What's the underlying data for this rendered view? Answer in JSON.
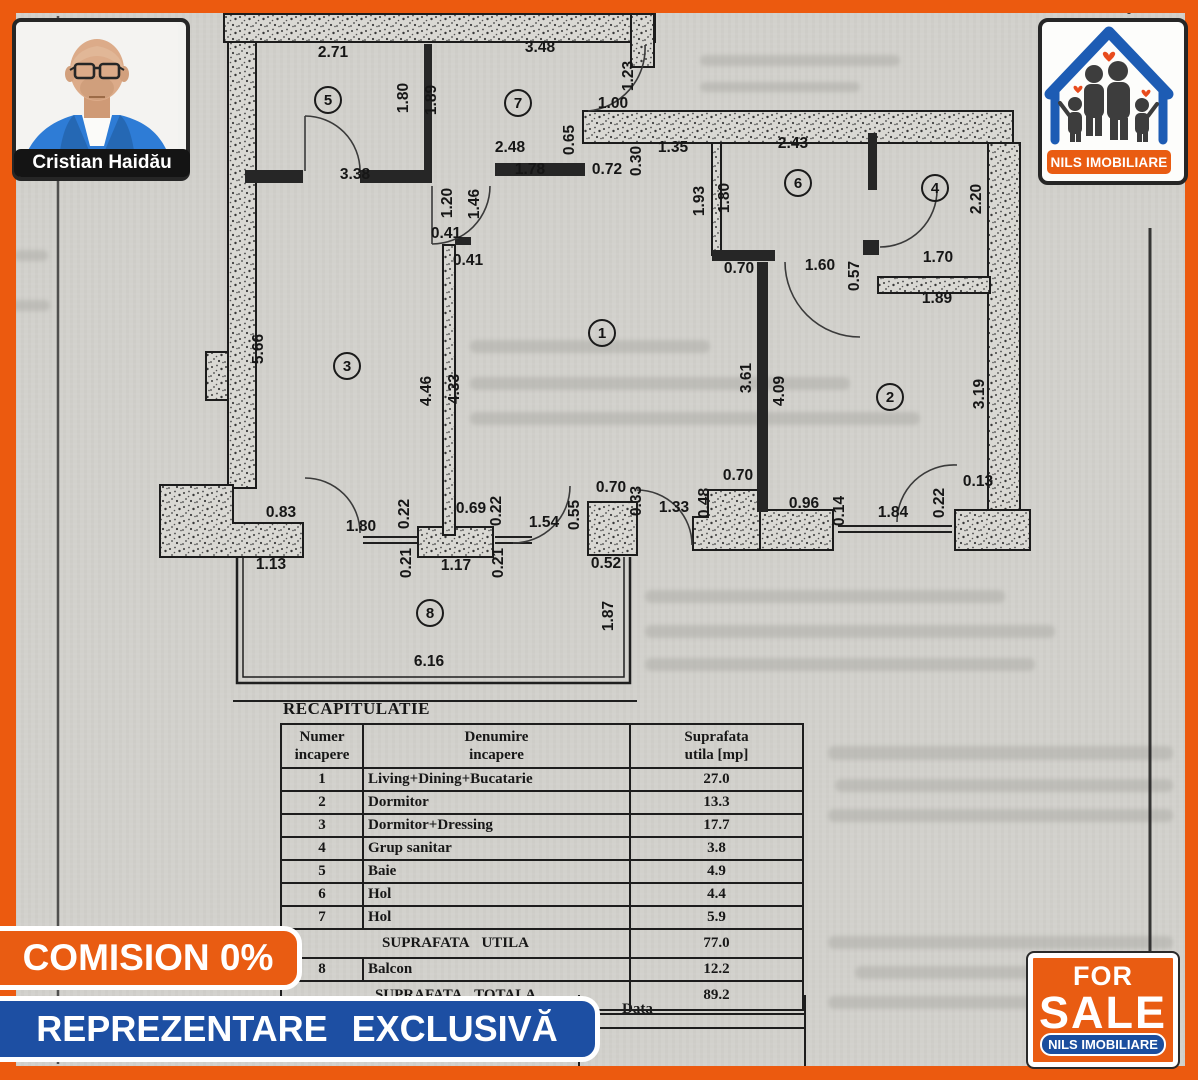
{
  "agent": {
    "name": "Cristian Haidău"
  },
  "brand": {
    "logo_text": "NILS IMOBILIARE",
    "orange": "#e95c12",
    "blue": "#1d4fa3",
    "logo_blue": "#1d5cb4"
  },
  "banners": {
    "commission": "COMISION 0%",
    "exclusive": "REPREZENTARE EXCLUSIVĂ"
  },
  "sale_badge": {
    "top": "FOR",
    "main": "SALE",
    "bottom": "NILS IMOBILIARE"
  },
  "recap": {
    "title": "RECAPITULATIE",
    "headers": [
      [
        "Numer",
        "incapere"
      ],
      [
        "Denumire",
        "incapere"
      ],
      [
        "Suprafata",
        "utila [mp]"
      ]
    ],
    "rows": [
      [
        "1",
        "Living+Dining+Bucatarie",
        "27.0"
      ],
      [
        "2",
        "Dormitor",
        "13.3"
      ],
      [
        "3",
        "Dormitor+Dressing",
        "17.7"
      ],
      [
        "4",
        "Grup sanitar",
        "3.8"
      ],
      [
        "5",
        "Baie",
        "4.9"
      ],
      [
        "6",
        "Hol",
        "4.4"
      ],
      [
        "7",
        "Hol",
        "5.9"
      ]
    ],
    "subtotal_label": "SUPRAFATA UTILA",
    "subtotal_value": "77.0",
    "balcony_row": [
      "8",
      "Balcon",
      "12.2"
    ],
    "total_label": "SUPRAFATA TOTALA",
    "total_value": "89.2",
    "data_label": "Data"
  },
  "floor_plan": {
    "rooms": [
      {
        "n": "1",
        "x": 602,
        "y": 333
      },
      {
        "n": "2",
        "x": 890,
        "y": 397
      },
      {
        "n": "3",
        "x": 347,
        "y": 366
      },
      {
        "n": "4",
        "x": 935,
        "y": 188
      },
      {
        "n": "5",
        "x": 328,
        "y": 100
      },
      {
        "n": "6",
        "x": 798,
        "y": 183
      },
      {
        "n": "7",
        "x": 518,
        "y": 103
      },
      {
        "n": "8",
        "x": 430,
        "y": 613
      }
    ],
    "dims": [
      {
        "t": "2.71",
        "x": 333,
        "y": 57,
        "v": 0
      },
      {
        "t": "3.48",
        "x": 540,
        "y": 52,
        "v": 0
      },
      {
        "t": "1.80",
        "x": 408,
        "y": 98,
        "v": 1
      },
      {
        "t": "1.89",
        "x": 436,
        "y": 100,
        "v": 1
      },
      {
        "t": "1.23",
        "x": 633,
        "y": 76,
        "v": 1
      },
      {
        "t": "1.00",
        "x": 613,
        "y": 108,
        "v": 0
      },
      {
        "t": "0.65",
        "x": 574,
        "y": 140,
        "v": 1
      },
      {
        "t": "2.48",
        "x": 510,
        "y": 152,
        "v": 0
      },
      {
        "t": "1.78",
        "x": 530,
        "y": 174,
        "v": 0
      },
      {
        "t": "0.72",
        "x": 607,
        "y": 174,
        "v": 0
      },
      {
        "t": "0.30",
        "x": 641,
        "y": 161,
        "v": 1
      },
      {
        "t": "1.35",
        "x": 673,
        "y": 152,
        "v": 0
      },
      {
        "t": "3.38",
        "x": 355,
        "y": 179,
        "v": 0
      },
      {
        "t": "1.20",
        "x": 452,
        "y": 203,
        "v": 1
      },
      {
        "t": "1.46",
        "x": 479,
        "y": 204,
        "v": 1
      },
      {
        "t": "2.43",
        "x": 793,
        "y": 148,
        "v": 0
      },
      {
        "t": "1.93",
        "x": 704,
        "y": 201,
        "v": 1
      },
      {
        "t": "1.80",
        "x": 729,
        "y": 198,
        "v": 1
      },
      {
        "t": "2.20",
        "x": 981,
        "y": 199,
        "v": 1
      },
      {
        "t": "0.70",
        "x": 739,
        "y": 273,
        "v": 0
      },
      {
        "t": "1.60",
        "x": 820,
        "y": 270,
        "v": 0
      },
      {
        "t": "0.57",
        "x": 859,
        "y": 276,
        "v": 1
      },
      {
        "t": "1.70",
        "x": 938,
        "y": 262,
        "v": 0
      },
      {
        "t": "1.89",
        "x": 937,
        "y": 303,
        "v": 0
      },
      {
        "t": "0.41",
        "x": 446,
        "y": 238,
        "v": 0
      },
      {
        "t": "0.41",
        "x": 468,
        "y": 265,
        "v": 0
      },
      {
        "t": "5.66",
        "x": 263,
        "y": 349,
        "v": 1
      },
      {
        "t": "4.46",
        "x": 431,
        "y": 391,
        "v": 1
      },
      {
        "t": "4.33",
        "x": 459,
        "y": 389,
        "v": 1
      },
      {
        "t": "3.61",
        "x": 751,
        "y": 378,
        "v": 1
      },
      {
        "t": "4.09",
        "x": 784,
        "y": 391,
        "v": 1
      },
      {
        "t": "3.19",
        "x": 984,
        "y": 394,
        "v": 1
      },
      {
        "t": "0.83",
        "x": 281,
        "y": 517,
        "v": 0
      },
      {
        "t": "1.13",
        "x": 271,
        "y": 569,
        "v": 0
      },
      {
        "t": "1.80",
        "x": 361,
        "y": 531,
        "v": 0
      },
      {
        "t": "0.22",
        "x": 409,
        "y": 514,
        "v": 1
      },
      {
        "t": "0.21",
        "x": 411,
        "y": 563,
        "v": 1
      },
      {
        "t": "0.69",
        "x": 471,
        "y": 513,
        "v": 0
      },
      {
        "t": "0.22",
        "x": 501,
        "y": 511,
        "v": 1
      },
      {
        "t": "0.21",
        "x": 503,
        "y": 563,
        "v": 1
      },
      {
        "t": "1.17",
        "x": 456,
        "y": 570,
        "v": 0
      },
      {
        "t": "1.54",
        "x": 544,
        "y": 527,
        "v": 0
      },
      {
        "t": "0.55",
        "x": 579,
        "y": 515,
        "v": 1
      },
      {
        "t": "0.70",
        "x": 611,
        "y": 492,
        "v": 0
      },
      {
        "t": "0.33",
        "x": 641,
        "y": 501,
        "v": 1
      },
      {
        "t": "1.33",
        "x": 674,
        "y": 512,
        "v": 0
      },
      {
        "t": "0.48",
        "x": 709,
        "y": 503,
        "v": 1
      },
      {
        "t": "0.70",
        "x": 738,
        "y": 480,
        "v": 0
      },
      {
        "t": "0.52",
        "x": 606,
        "y": 568,
        "v": 0
      },
      {
        "t": "1.87",
        "x": 613,
        "y": 616,
        "v": 1
      },
      {
        "t": "6.16",
        "x": 429,
        "y": 666,
        "v": 0
      },
      {
        "t": "0.96",
        "x": 804,
        "y": 508,
        "v": 0
      },
      {
        "t": "0.14",
        "x": 844,
        "y": 511,
        "v": 1
      },
      {
        "t": "1.84",
        "x": 893,
        "y": 517,
        "v": 0
      },
      {
        "t": "0.22",
        "x": 944,
        "y": 503,
        "v": 1
      },
      {
        "t": "0.13",
        "x": 978,
        "y": 486,
        "v": 0
      }
    ]
  }
}
